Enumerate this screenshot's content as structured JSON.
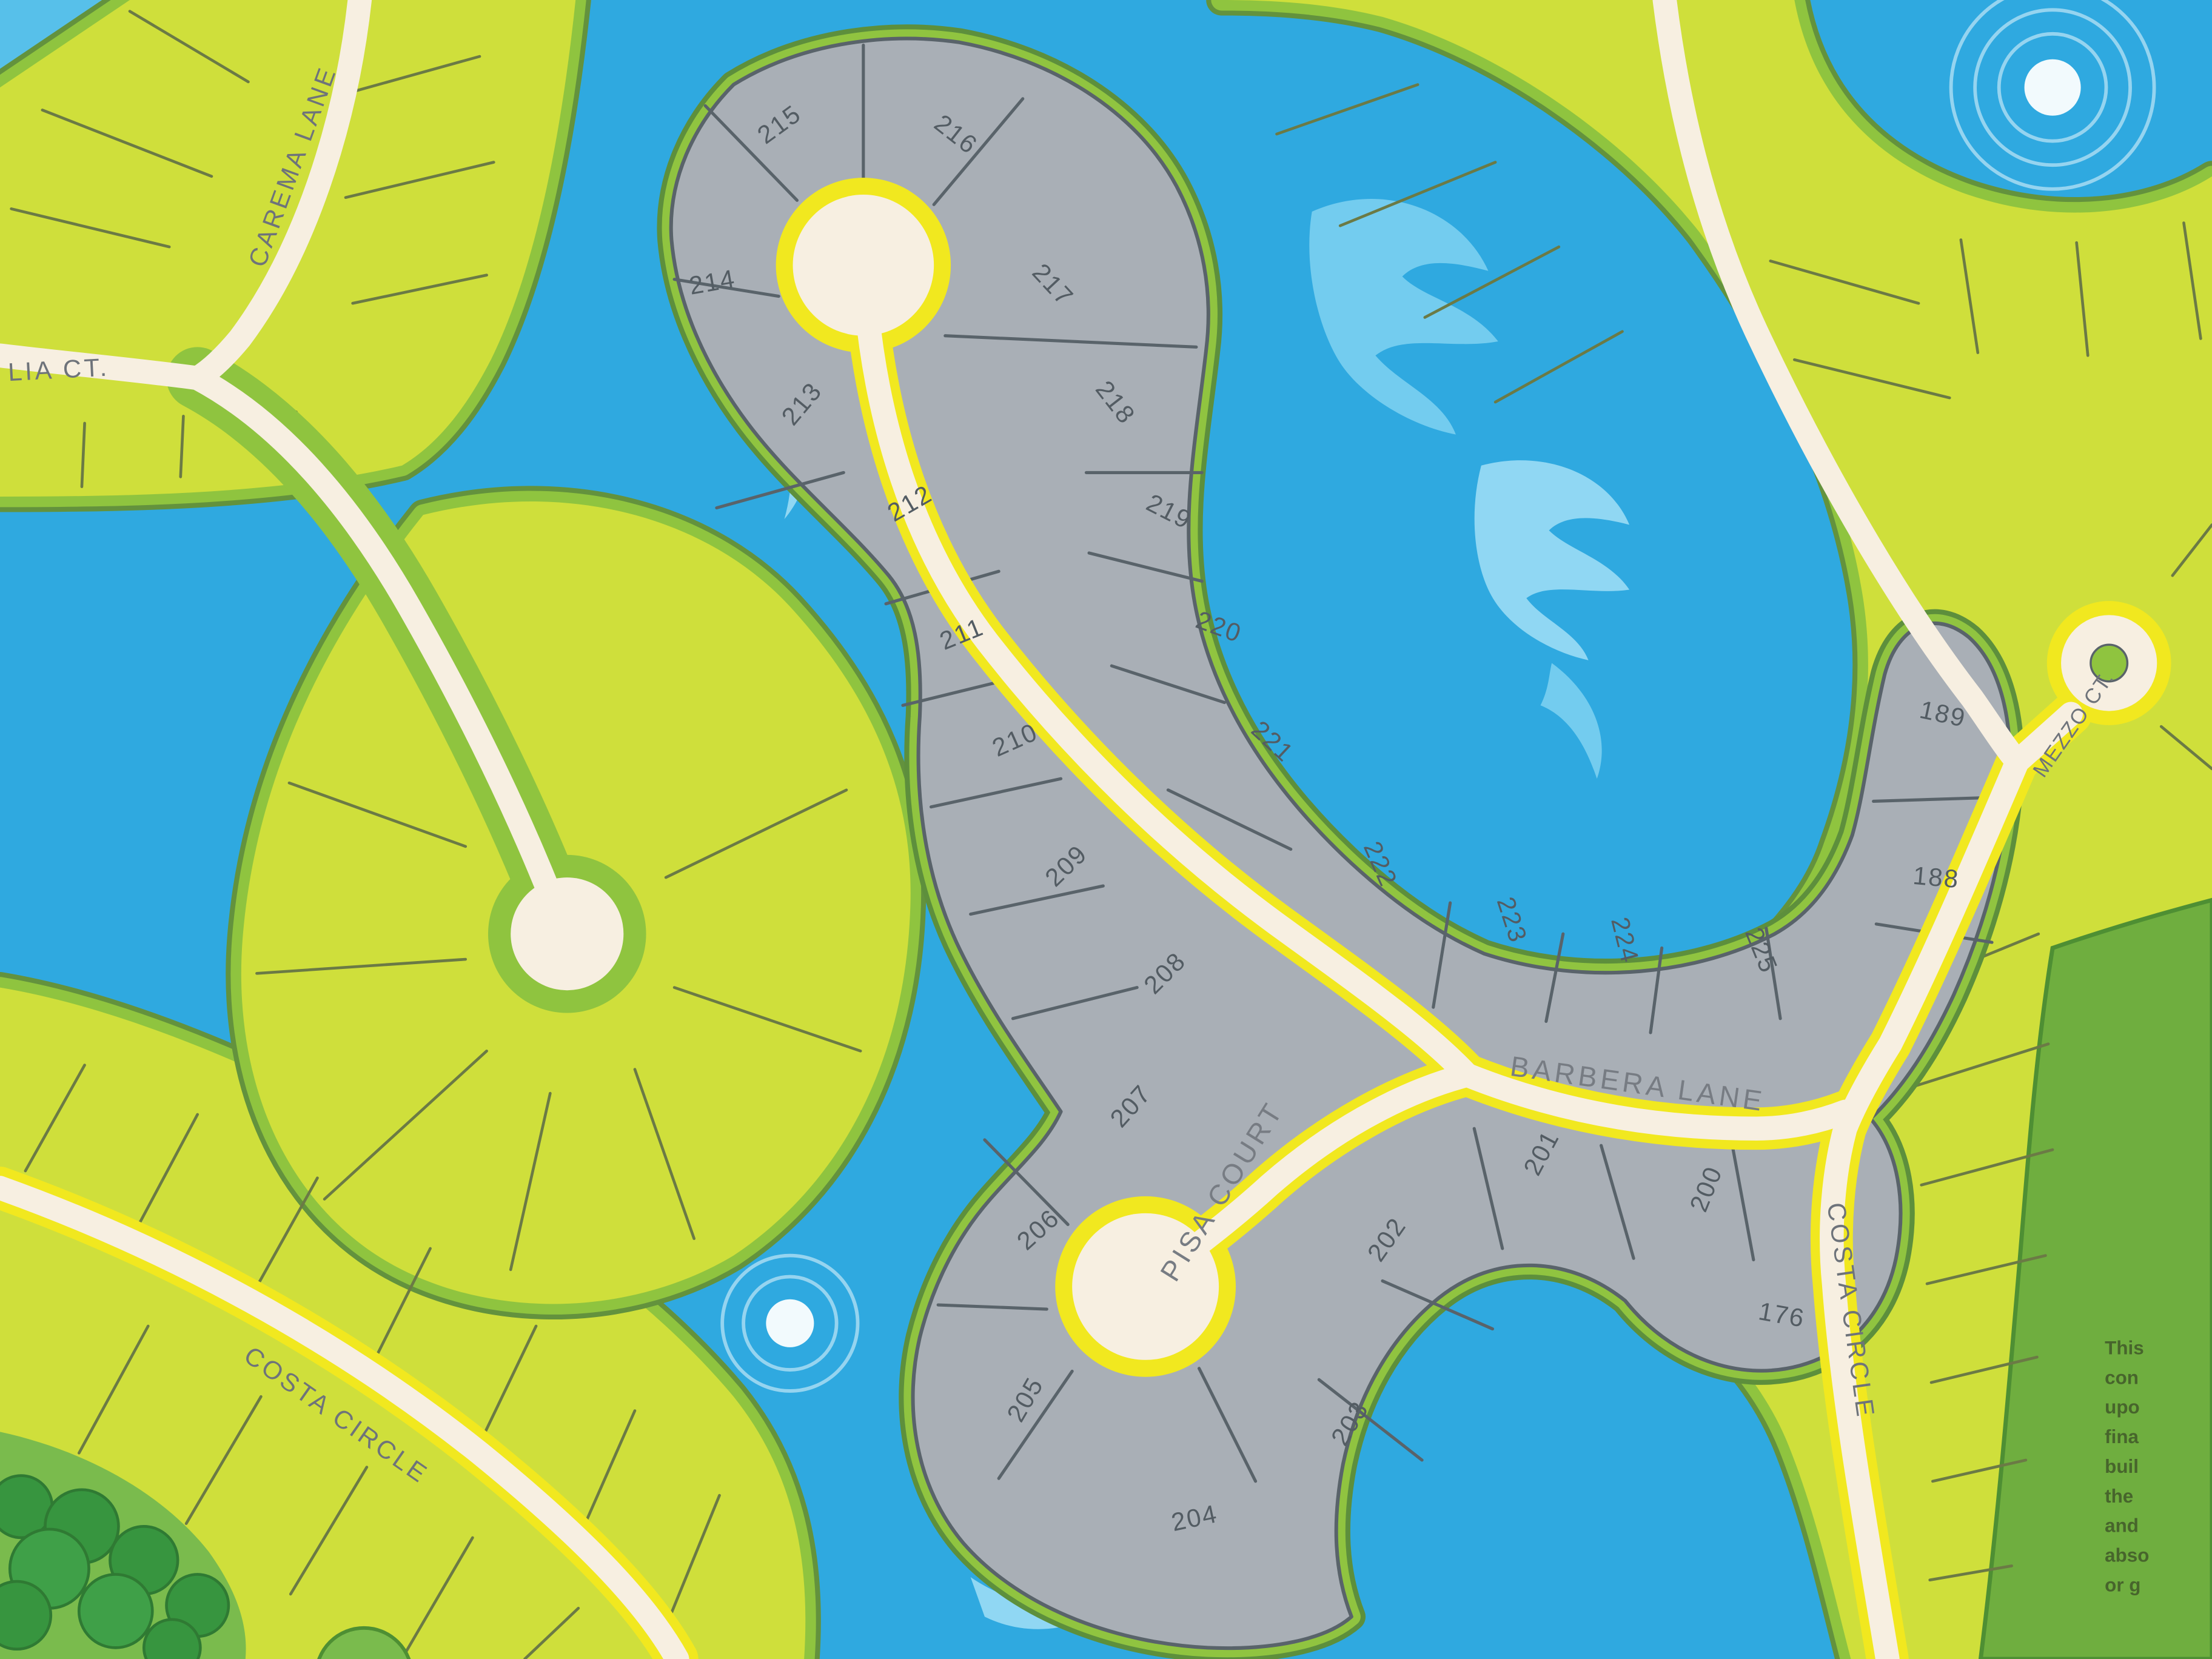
{
  "title": "Community lot plat map",
  "streets": {
    "carema_lane": "CAREMA LANE",
    "lia_ct": "LIA CT.",
    "pisa_court": "PISA COURT",
    "barbera_lane": "BARBERA LANE",
    "costa_circle_east": "COSTA CIRCLE",
    "costa_circle_southwest": "COSTA CIRCLE",
    "mezzo_ct": "MEZZO CT."
  },
  "lots": [
    {
      "number": "215"
    },
    {
      "number": "216"
    },
    {
      "number": "214"
    },
    {
      "number": "217"
    },
    {
      "number": "213"
    },
    {
      "number": "218"
    },
    {
      "number": "212"
    },
    {
      "number": "219"
    },
    {
      "number": "211"
    },
    {
      "number": "220"
    },
    {
      "number": "210"
    },
    {
      "number": "221"
    },
    {
      "number": "209"
    },
    {
      "number": "208"
    },
    {
      "number": "222"
    },
    {
      "number": "223"
    },
    {
      "number": "224"
    },
    {
      "number": "225"
    },
    {
      "number": "189"
    },
    {
      "number": "188"
    },
    {
      "number": "207"
    },
    {
      "number": "206"
    },
    {
      "number": "205"
    },
    {
      "number": "204"
    },
    {
      "number": "203"
    },
    {
      "number": "202"
    },
    {
      "number": "201"
    },
    {
      "number": "200"
    },
    {
      "number": "176"
    }
  ],
  "legal_note": {
    "lines": [
      "This",
      "con",
      "upo",
      "fina",
      "buil",
      "the",
      "and",
      "abso",
      "or g"
    ]
  },
  "colors": {
    "water": "#2FA9E0",
    "lot_green": "#CFDF3B",
    "shore_green": "#8FC43F",
    "lot_gray": "#A9AFB6",
    "road_cream": "#F7EFE1",
    "road_yellow": "#F1E81F",
    "preserve_green": "#6FAE3F",
    "line_dark": "#59636A"
  }
}
